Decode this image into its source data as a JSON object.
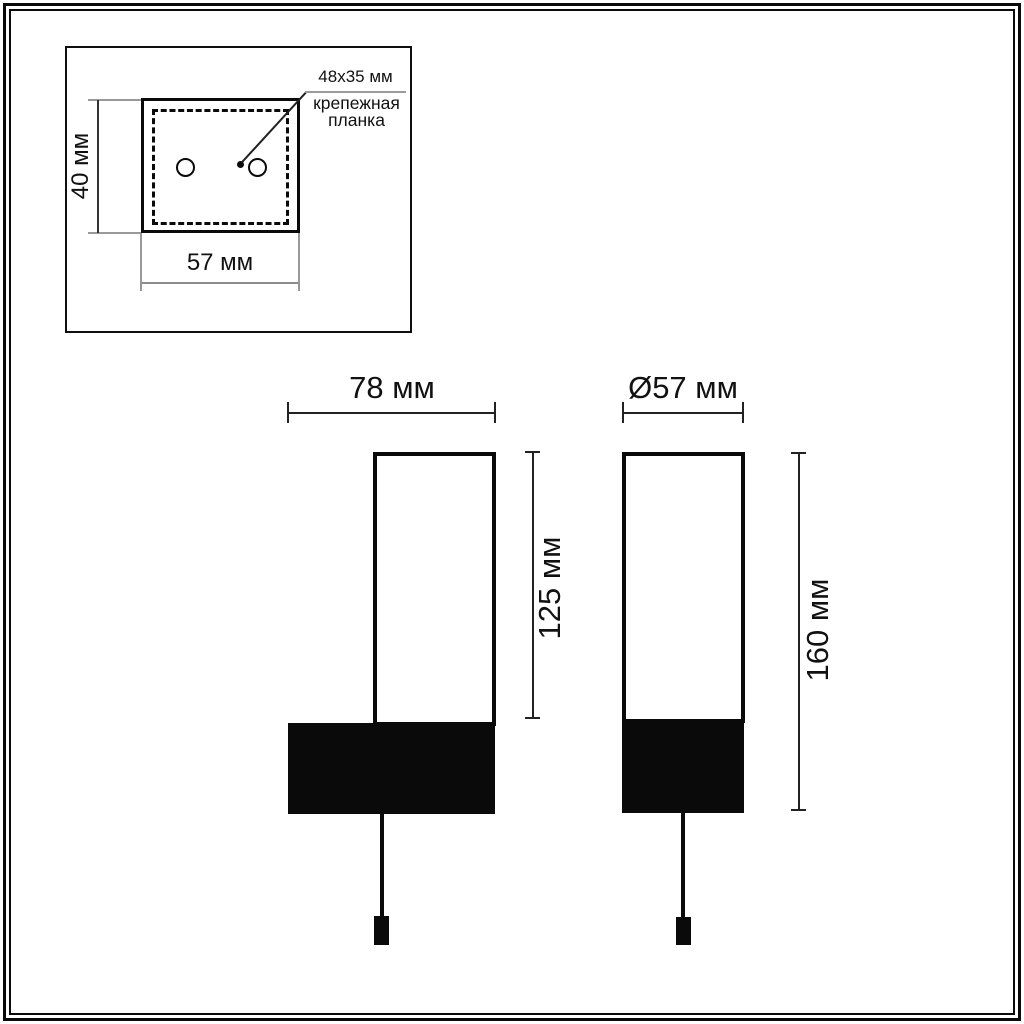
{
  "inset": {
    "plate_size_label": "48x35 мм",
    "plate_name_line1": "крепежная",
    "plate_name_line2": "планка",
    "height_dimension": "40 мм",
    "width_dimension": "57 мм"
  },
  "front_view": {
    "width_dimension": "78 мм",
    "shade_height_dimension": "125 мм"
  },
  "side_view": {
    "diameter_dimension": "Ø57 мм",
    "height_dimension": "160 мм"
  },
  "colors": {
    "line_black": "#0a0a0a",
    "line_gray": "#999999",
    "background": "#ffffff"
  }
}
